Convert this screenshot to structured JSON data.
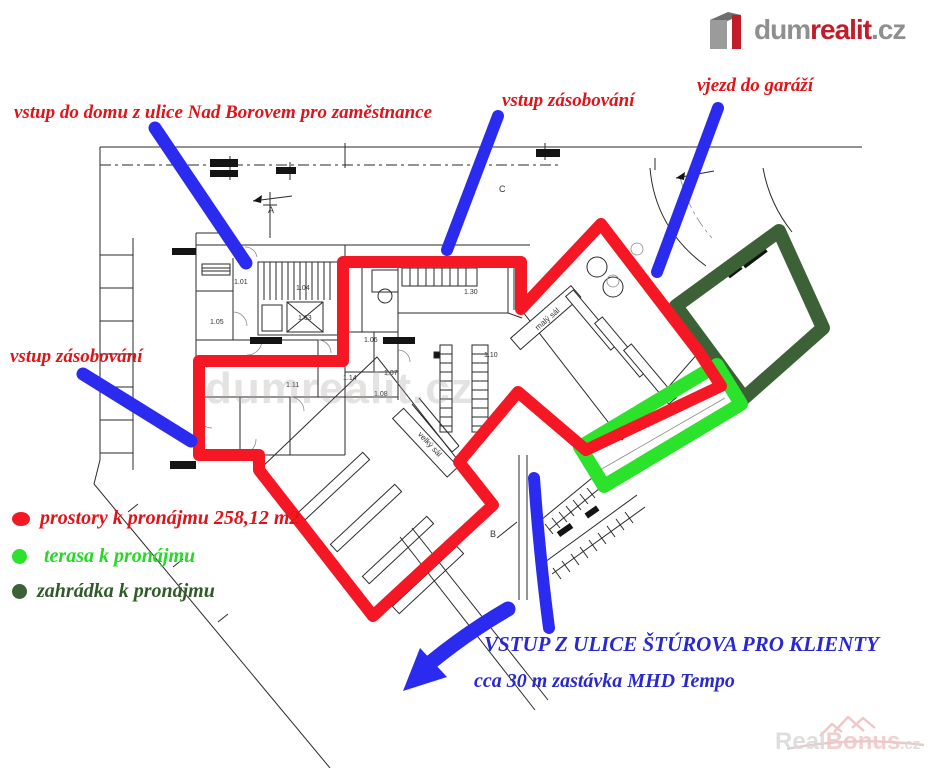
{
  "colors": {
    "red_outline": "#f51723",
    "red_text": "#e01418",
    "blue_arrow": "#2b2bf0",
    "blue_text": "#2929cf",
    "green_line": "#2be32b",
    "green_text": "#27d827",
    "dark_green_line": "#3d6136",
    "dark_green_text": "#2f5b28",
    "plan_line": "#2a2a2a",
    "logo_gray": "#8f8f8f",
    "logo_red": "#c01c2a",
    "rb_gray": "#d9d9d9",
    "rb_pink": "#eec7c7"
  },
  "logo": {
    "word_gray": "dum",
    "word_red": "realit",
    "tld": ".cz"
  },
  "annotations": {
    "employee_entrance": "vstup do domu z ulice Nad Borovem pro zaměstnance",
    "supply_top": "vstup zásobování",
    "garage": "vjezd do garáží",
    "supply_left": "vstup zásobování",
    "client_entrance": "VSTUP Z ULICE ŠTÚROVA PRO KLIENTY",
    "bus_stop": "cca 30 m zastávka MHD Tempo"
  },
  "legend": {
    "items": [
      {
        "label": "prostory k pronájmu 258,12 m2"
      },
      {
        "label": "terasa k pronájmu"
      },
      {
        "label": "zahrádka k pronájmu"
      }
    ]
  },
  "watermark_center": "dumrealit.cz",
  "realbonus": {
    "real": "Real",
    "bonus": "Bonus",
    "cz": ".cz"
  },
  "overlay": {
    "rental_outline": {
      "points": "199,361 343,361 343,262 521,262 521,309 601,224 699,352 721,386 586,450 518,392 459,462 493,505 373,616 259,470 259,455 199,455"
    },
    "terrace": {
      "points": "580,447 717,365 741,404 604,486"
    },
    "garden": {
      "points": "779,231 676,306 744,398 823,328"
    },
    "arrows": [
      {
        "d": "M155,128 L246,263",
        "w": 13
      },
      {
        "d": "M498,116 L447,250",
        "w": 12
      },
      {
        "d": "M718,108 L657,272",
        "w": 12
      },
      {
        "d": "M83,374 L191,441",
        "w": 13
      },
      {
        "d": "M534,478 Q540,560 549,628",
        "w": 12
      },
      {
        "d": "M508,609 Q468,632 430,663",
        "w": 15
      }
    ],
    "arrow_head": "403,691 420,648 447,677"
  },
  "plan": {
    "labels": [
      {
        "t": "1.01",
        "x": 234,
        "y": 284
      },
      {
        "t": "1.04",
        "x": 296,
        "y": 290
      },
      {
        "t": "1.63",
        "x": 298,
        "y": 320
      },
      {
        "t": "1.05",
        "x": 210,
        "y": 324
      },
      {
        "t": "1.06",
        "x": 364,
        "y": 342
      },
      {
        "t": "1.11",
        "x": 286,
        "y": 387
      },
      {
        "t": "1.07",
        "x": 384,
        "y": 375
      },
      {
        "t": "1.08",
        "x": 374,
        "y": 396
      },
      {
        "t": "1.14",
        "x": 343,
        "y": 380
      },
      {
        "t": "1.10",
        "x": 484,
        "y": 357
      },
      {
        "t": "1.30",
        "x": 464,
        "y": 294
      },
      {
        "t": "A",
        "x": 268,
        "y": 213,
        "s": 9
      },
      {
        "t": "B",
        "x": 686,
        "y": 192,
        "s": 9
      },
      {
        "t": "C",
        "x": 499,
        "y": 192,
        "s": 9
      },
      {
        "t": "B",
        "x": 490,
        "y": 537,
        "s": 9
      },
      {
        "t": "malý sál",
        "tr": "translate(549,321) rotate(-41)",
        "s": 8
      },
      {
        "t": "velký sál",
        "tr": "translate(428,446) rotate(47)",
        "s": 8
      }
    ]
  }
}
